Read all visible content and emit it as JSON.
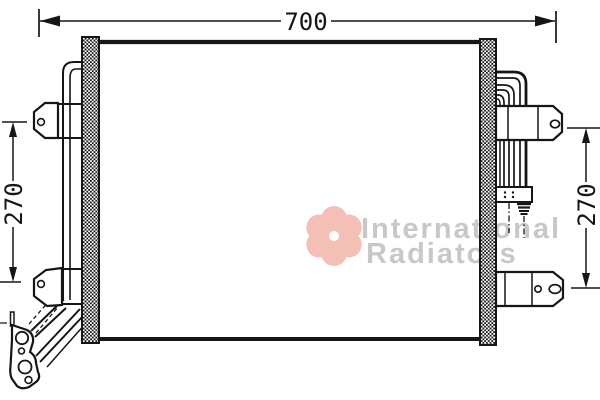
{
  "dimensions": {
    "width": {
      "label": "700"
    },
    "height_left": {
      "label": "270"
    },
    "height_right": {
      "label": "270"
    }
  },
  "watermark": {
    "line1": "International",
    "line2": "Radiators"
  },
  "colors": {
    "line": "#161616",
    "background": "#ffffff",
    "watermark_text": "#c8c8c8",
    "watermark_logo": "#f4c0b6"
  }
}
